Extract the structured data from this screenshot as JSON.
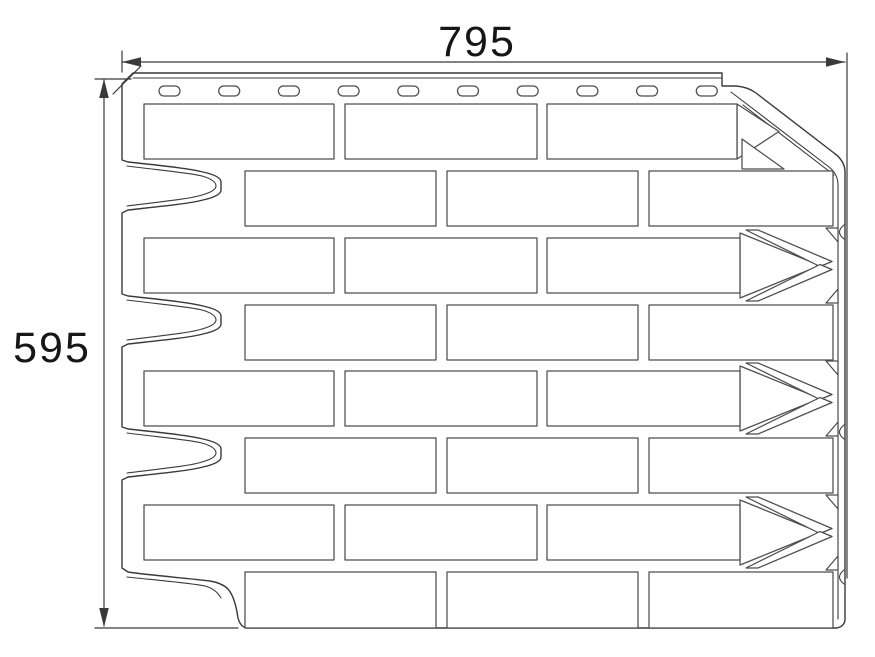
{
  "dimensions": {
    "width": {
      "label": "795"
    },
    "height": {
      "label": "595"
    }
  },
  "panel": {
    "slot_count": 10,
    "brick_row_count": 8,
    "arrow_row_indexes": [
      3,
      5,
      7
    ],
    "flush_row_indexes": [
      2,
      4,
      6,
      8
    ]
  },
  "colors": {
    "line": "#3a3a3a",
    "brick_line": "#4d4d4d",
    "text": "#161616",
    "background": "#ffffff"
  }
}
